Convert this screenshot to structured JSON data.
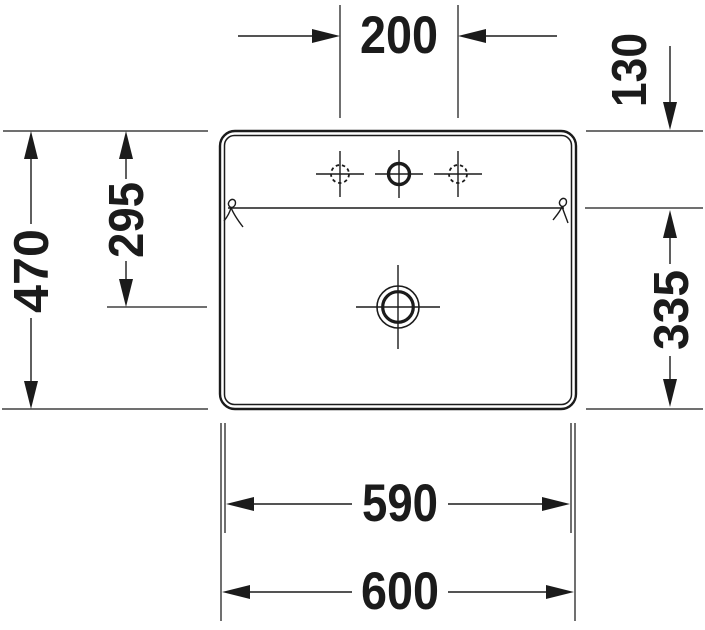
{
  "drawing": {
    "kind": "washbasin-plan-view-technical-drawing",
    "unit_note": "mm"
  },
  "dimensions": {
    "faucet_holes_spacing": "200",
    "back_shelf_depth": "130",
    "overall_depth": "470",
    "back_to_drain_center": "295",
    "shelf_edge_to_front": "335",
    "base_width": "590",
    "overall_width": "600"
  },
  "colors": {
    "line": "#1b1b1b",
    "background": "#ffffff"
  }
}
